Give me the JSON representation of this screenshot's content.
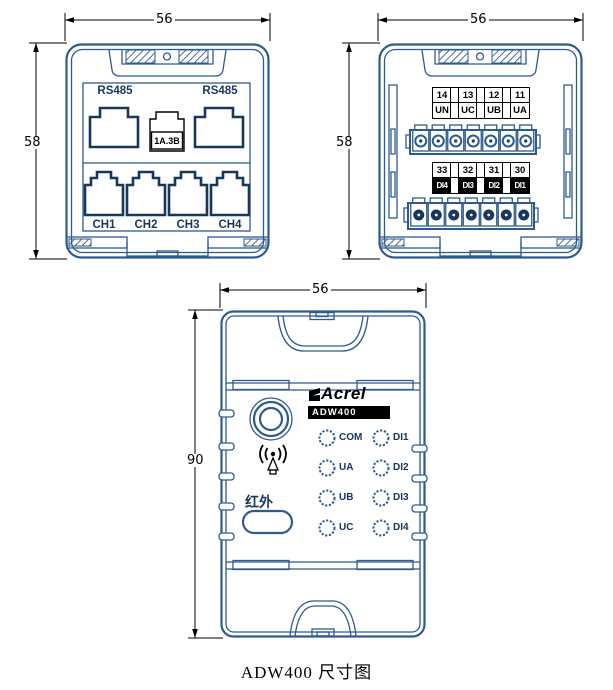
{
  "caption": "ADW400 尺寸图",
  "colors": {
    "outline_blue": "#2e5b8f",
    "port_navy": "#17375d",
    "dimension_black": "#000000",
    "model_bar_bg": "#000000",
    "model_bar_text": "#ffffff"
  },
  "views": {
    "top_left": {
      "width_dim": "56",
      "height_dim": "58",
      "rs485_left": "RS485",
      "rs485_right": "RS485",
      "mid_connector": "1A.3B",
      "channels": [
        "CH1",
        "CH2",
        "CH3",
        "CH4"
      ]
    },
    "top_right": {
      "width_dim": "56",
      "height_dim": "58",
      "row1_numbers": [
        "14",
        "13",
        "12",
        "11"
      ],
      "row1_names": [
        "UN",
        "UC",
        "UB",
        "UA"
      ],
      "row2_numbers": [
        "33",
        "32",
        "31",
        "30"
      ],
      "row2_names": [
        "DI4",
        "DI3",
        "DI2",
        "DI1"
      ]
    },
    "front": {
      "width_dim": "56",
      "height_dim": "90",
      "brand": "Acrel",
      "model": "ADW400",
      "infrared": "红外",
      "leds_left": [
        "COM",
        "UA",
        "UB",
        "UC"
      ],
      "leds_right": [
        "DI1",
        "DI2",
        "DI3",
        "DI4"
      ]
    }
  }
}
